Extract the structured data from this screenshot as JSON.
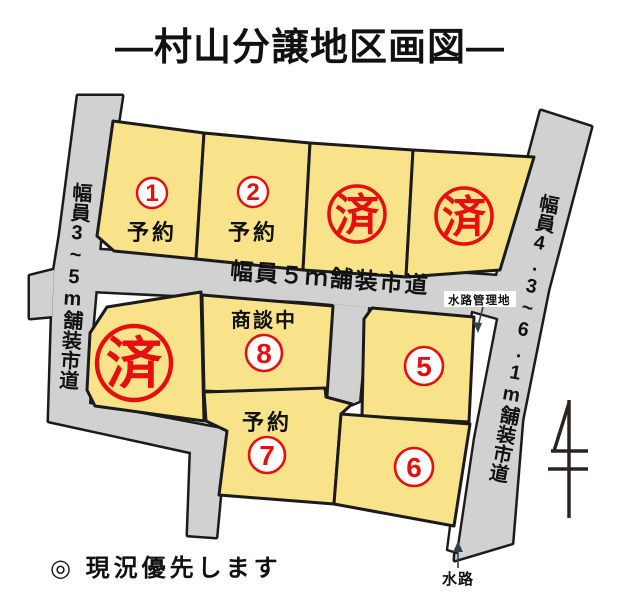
{
  "title": "―村山分譲地区画図―",
  "note": "◎ 現況優先します",
  "roads": {
    "left": "幅員3~5m舗装市道",
    "center": "幅員５ｍ舗装市道",
    "right": "幅員4.3~6.1m舗装市道"
  },
  "annotations": {
    "waterway_managed": "水路管理地",
    "waterway": "水路"
  },
  "plots": [
    {
      "number": "1",
      "status": "予約"
    },
    {
      "number": "2",
      "status": "予約"
    },
    {
      "number": "",
      "status": "済"
    },
    {
      "number": "",
      "status": "済"
    },
    {
      "number": "",
      "status": "済"
    },
    {
      "number": "8",
      "status": "商談中"
    },
    {
      "number": "7",
      "status": "予約"
    },
    {
      "number": "5",
      "status": ""
    },
    {
      "number": "6",
      "status": ""
    }
  ],
  "colors": {
    "plot_fill": "#F8E38A",
    "road_fill": "#D2D1D1",
    "outline": "#1B1B1B",
    "accent_red": "#E60F0F",
    "text": "#111111"
  }
}
